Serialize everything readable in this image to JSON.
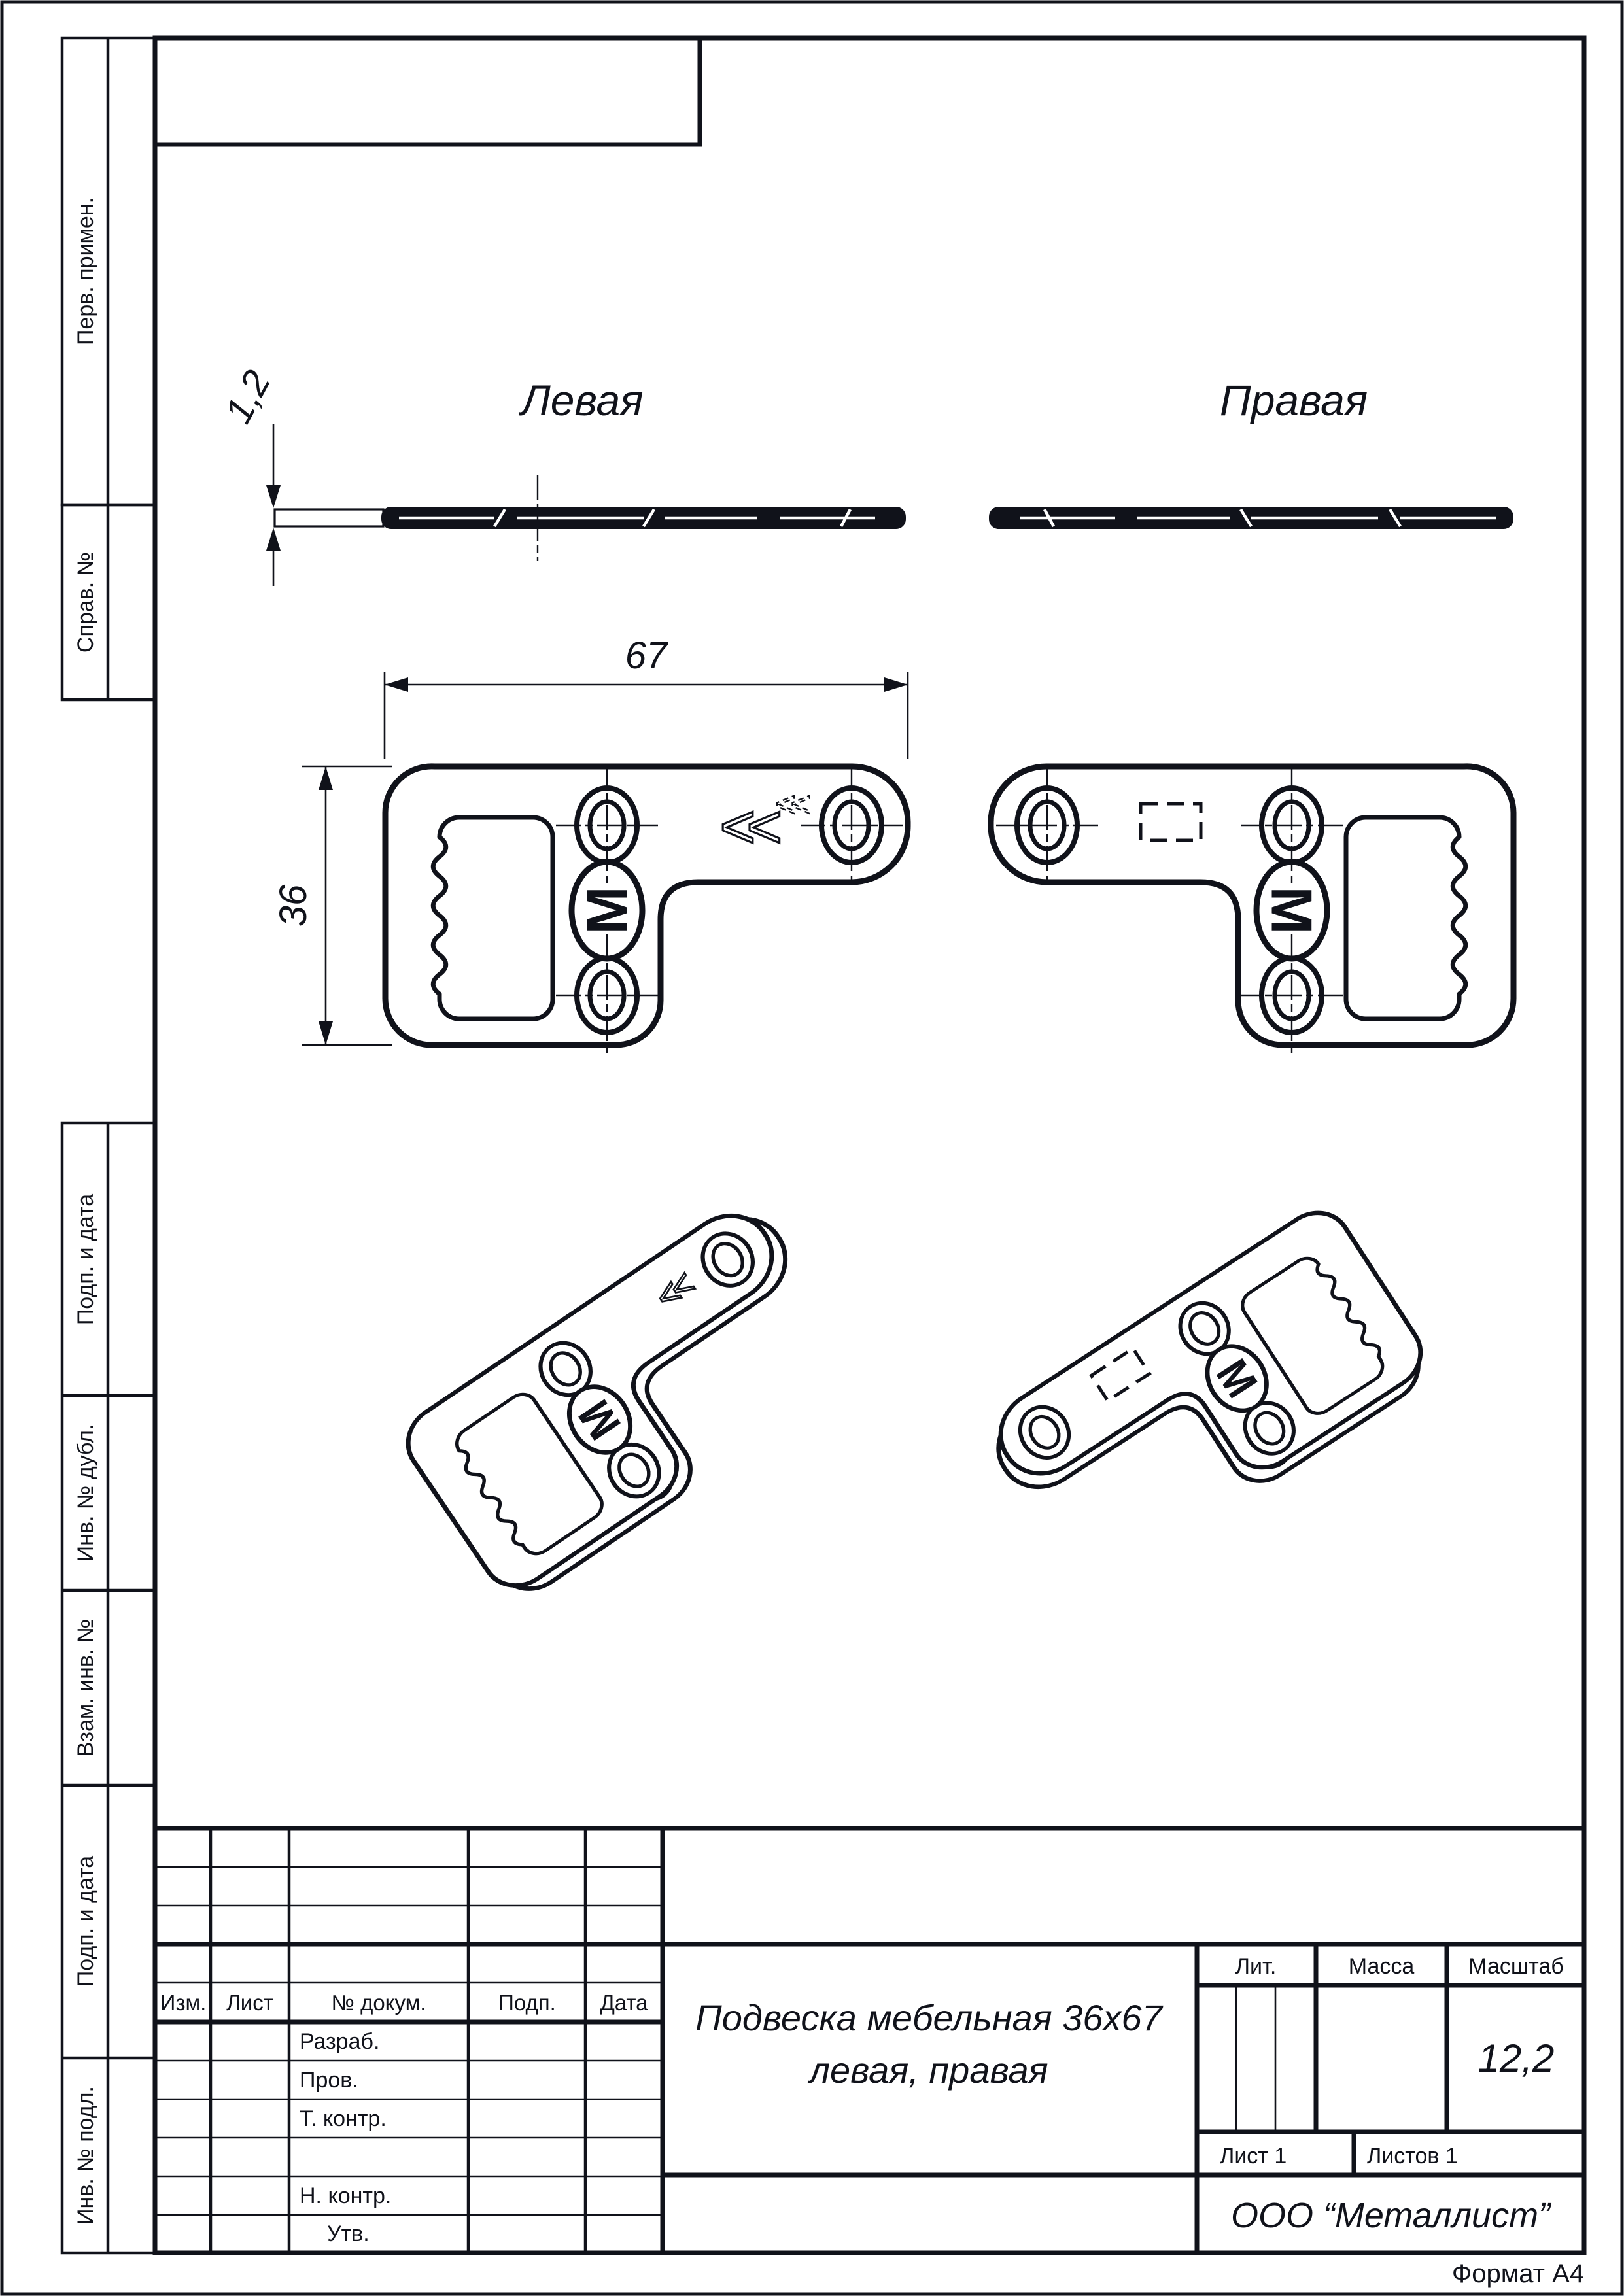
{
  "page": {
    "format_note": "Формат А4"
  },
  "margin_columns": {
    "perv_primen": "Перв. примен.",
    "sprav_no": "Справ. №",
    "podp_i_data_1": "Подп. и дата",
    "inv_no_dubl": "Инв. № дубл.",
    "vzam_inv_no": "Взам. инв. №",
    "podp_i_data_2": "Подп. и дата",
    "inv_no_podl": "Инв. № подл."
  },
  "views": {
    "left_title": "Левая",
    "right_title": "Правая"
  },
  "dimensions": {
    "thickness": "1,2",
    "width": "67",
    "height": "36"
  },
  "marks": {
    "chevron": "<<",
    "logo_letter": "M"
  },
  "title_block": {
    "col_izm": "Изм.",
    "col_list": "Лист",
    "col_dokum": "№ докум.",
    "col_podp": "Подп.",
    "col_data": "Дата",
    "row_razrab": "Разраб.",
    "row_prov": "Пров.",
    "row_tkontr": "Т. контр.",
    "row_nkontr": "Н. контр.",
    "row_utv": "Утв.",
    "name_line1": "Подвеска мебельная 36х67",
    "name_line2": "левая, правая",
    "lit_label": "Лит.",
    "massa_label": "Масса",
    "masshtab_label": "Масштаб",
    "masshtab_value": "12,2",
    "list_value": "Лист 1",
    "listov_value": "Листов 1",
    "company": "ООО “Металлист”"
  }
}
